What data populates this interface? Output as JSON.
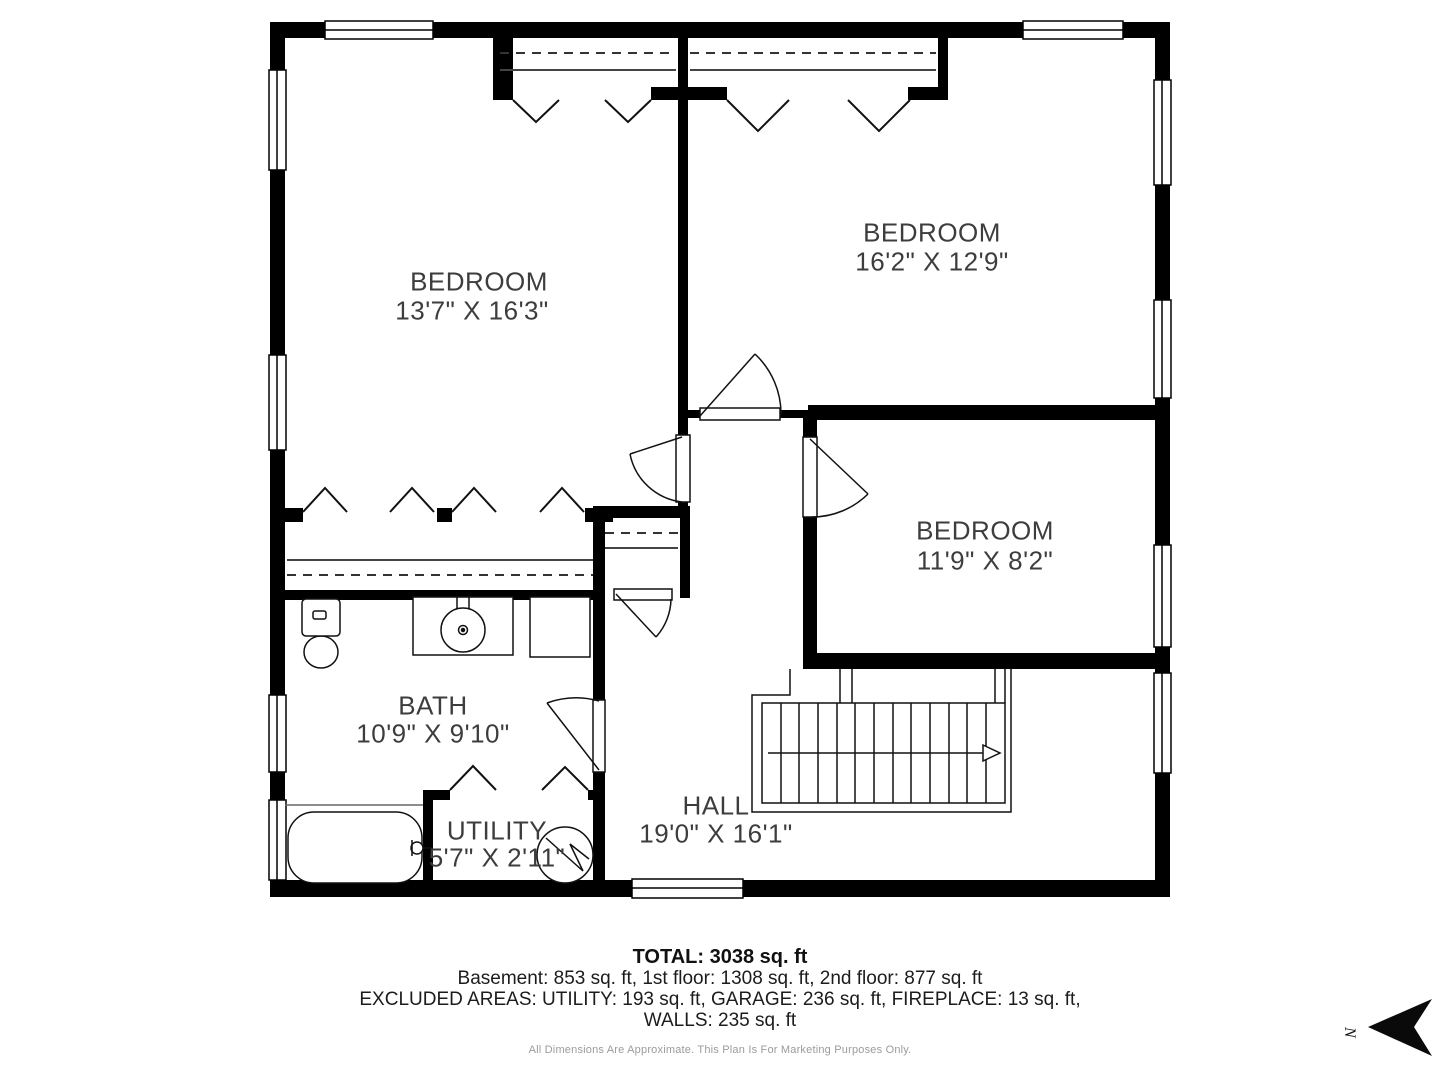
{
  "rooms": {
    "bedroom1": {
      "name": "BEDROOM",
      "dims": "13'7\" X 16'3\""
    },
    "bedroom2": {
      "name": "BEDROOM",
      "dims": "16'2\" X 12'9\""
    },
    "bedroom3": {
      "name": "BEDROOM",
      "dims": "11'9\" X 8'2\""
    },
    "bath": {
      "name": "BATH",
      "dims": "10'9\" X 9'10\""
    },
    "utility": {
      "name": "UTILITY",
      "dims": "5'7\" X 2'11\""
    },
    "hall": {
      "name": "HALL",
      "dims": "19'0\" X 16'1\""
    }
  },
  "footer": {
    "total": "TOTAL: 3038 sq. ft",
    "floors": "Basement: 853 sq. ft, 1st floor: 1308 sq. ft, 2nd floor: 877 sq. ft",
    "excluded": "EXCLUDED AREAS: UTILITY: 193 sq. ft, GARAGE: 236 sq. ft, FIREPLACE: 13 sq. ft,",
    "walls": "WALLS: 235 sq. ft",
    "disclaimer": "All Dimensions Are Approximate. This Plan Is For Marketing Purposes Only."
  },
  "compass": {
    "north_label": "N"
  },
  "colors": {
    "wall": "#000000",
    "label_text": "#3d3d3d",
    "footer_text": "#1c1c1c",
    "disclaimer_text": "#9b9b9b"
  }
}
